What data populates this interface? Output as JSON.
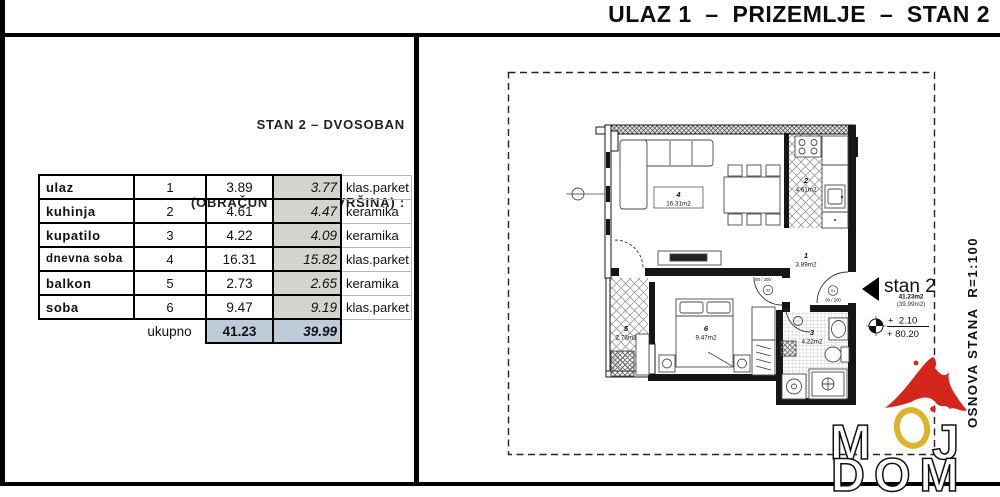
{
  "header": {
    "title": "ULAZ 1  –  PRIZEMLJE  –  STAN 2"
  },
  "panel": {
    "line1": "STAN 2 – DVOSOBAN",
    "line2": "(OBRAČUN NETO POVRŠINA) :"
  },
  "table": {
    "rows": [
      {
        "name": "ulaz",
        "num": "1",
        "gross": "3.89",
        "net": "3.77",
        "floor": "klas.parket"
      },
      {
        "name": "kuhinja",
        "num": "2",
        "gross": "4.61",
        "net": "4.47",
        "floor": "keramika"
      },
      {
        "name": "kupatilo",
        "num": "3",
        "gross": "4.22",
        "net": "4.09",
        "floor": "keramika"
      },
      {
        "name": "dnevna soba",
        "num": "4",
        "gross": "16.31",
        "net": "15.82",
        "floor": "klas.parket"
      },
      {
        "name": "balkon",
        "num": "5",
        "gross": "2.73",
        "net": "2.65",
        "floor": "keramika"
      },
      {
        "name": "soba",
        "num": "6",
        "gross": "9.47",
        "net": "9.19",
        "floor": "klas.parket"
      }
    ],
    "total": {
      "label": "ukupno",
      "gross": "41.23",
      "net": "39.99"
    }
  },
  "plan": {
    "rooms": [
      {
        "num": "1",
        "area": "3.89m2"
      },
      {
        "num": "2",
        "area": "4.61m2"
      },
      {
        "num": "3",
        "area": "4.22m2"
      },
      {
        "num": "4",
        "area": "16.31m2"
      },
      {
        "num": "5",
        "area": "2.73m2"
      },
      {
        "num": "6",
        "area": "9.47m2"
      }
    ],
    "doors": [
      {
        "id": "01",
        "size": "90 / 200"
      },
      {
        "id": "02",
        "size": "80 / 200"
      }
    ],
    "stan": {
      "name": "stan 2",
      "area": "41.23m2",
      "net": "(39.99m2)"
    },
    "elevation": {
      "relative": "+  2.10",
      "absolute": "+ 80.20"
    },
    "side_text": "OSNOVA STANA  R=1:100"
  },
  "logo": {
    "m": "M",
    "j": "J",
    "bottom": "DOM"
  },
  "colors": {
    "wall": "#161616",
    "net_column_bg": "#d3d3cf",
    "total_bg": "#becbd9",
    "logo_red": "#d4271c",
    "logo_gold": "#ddb32a"
  }
}
